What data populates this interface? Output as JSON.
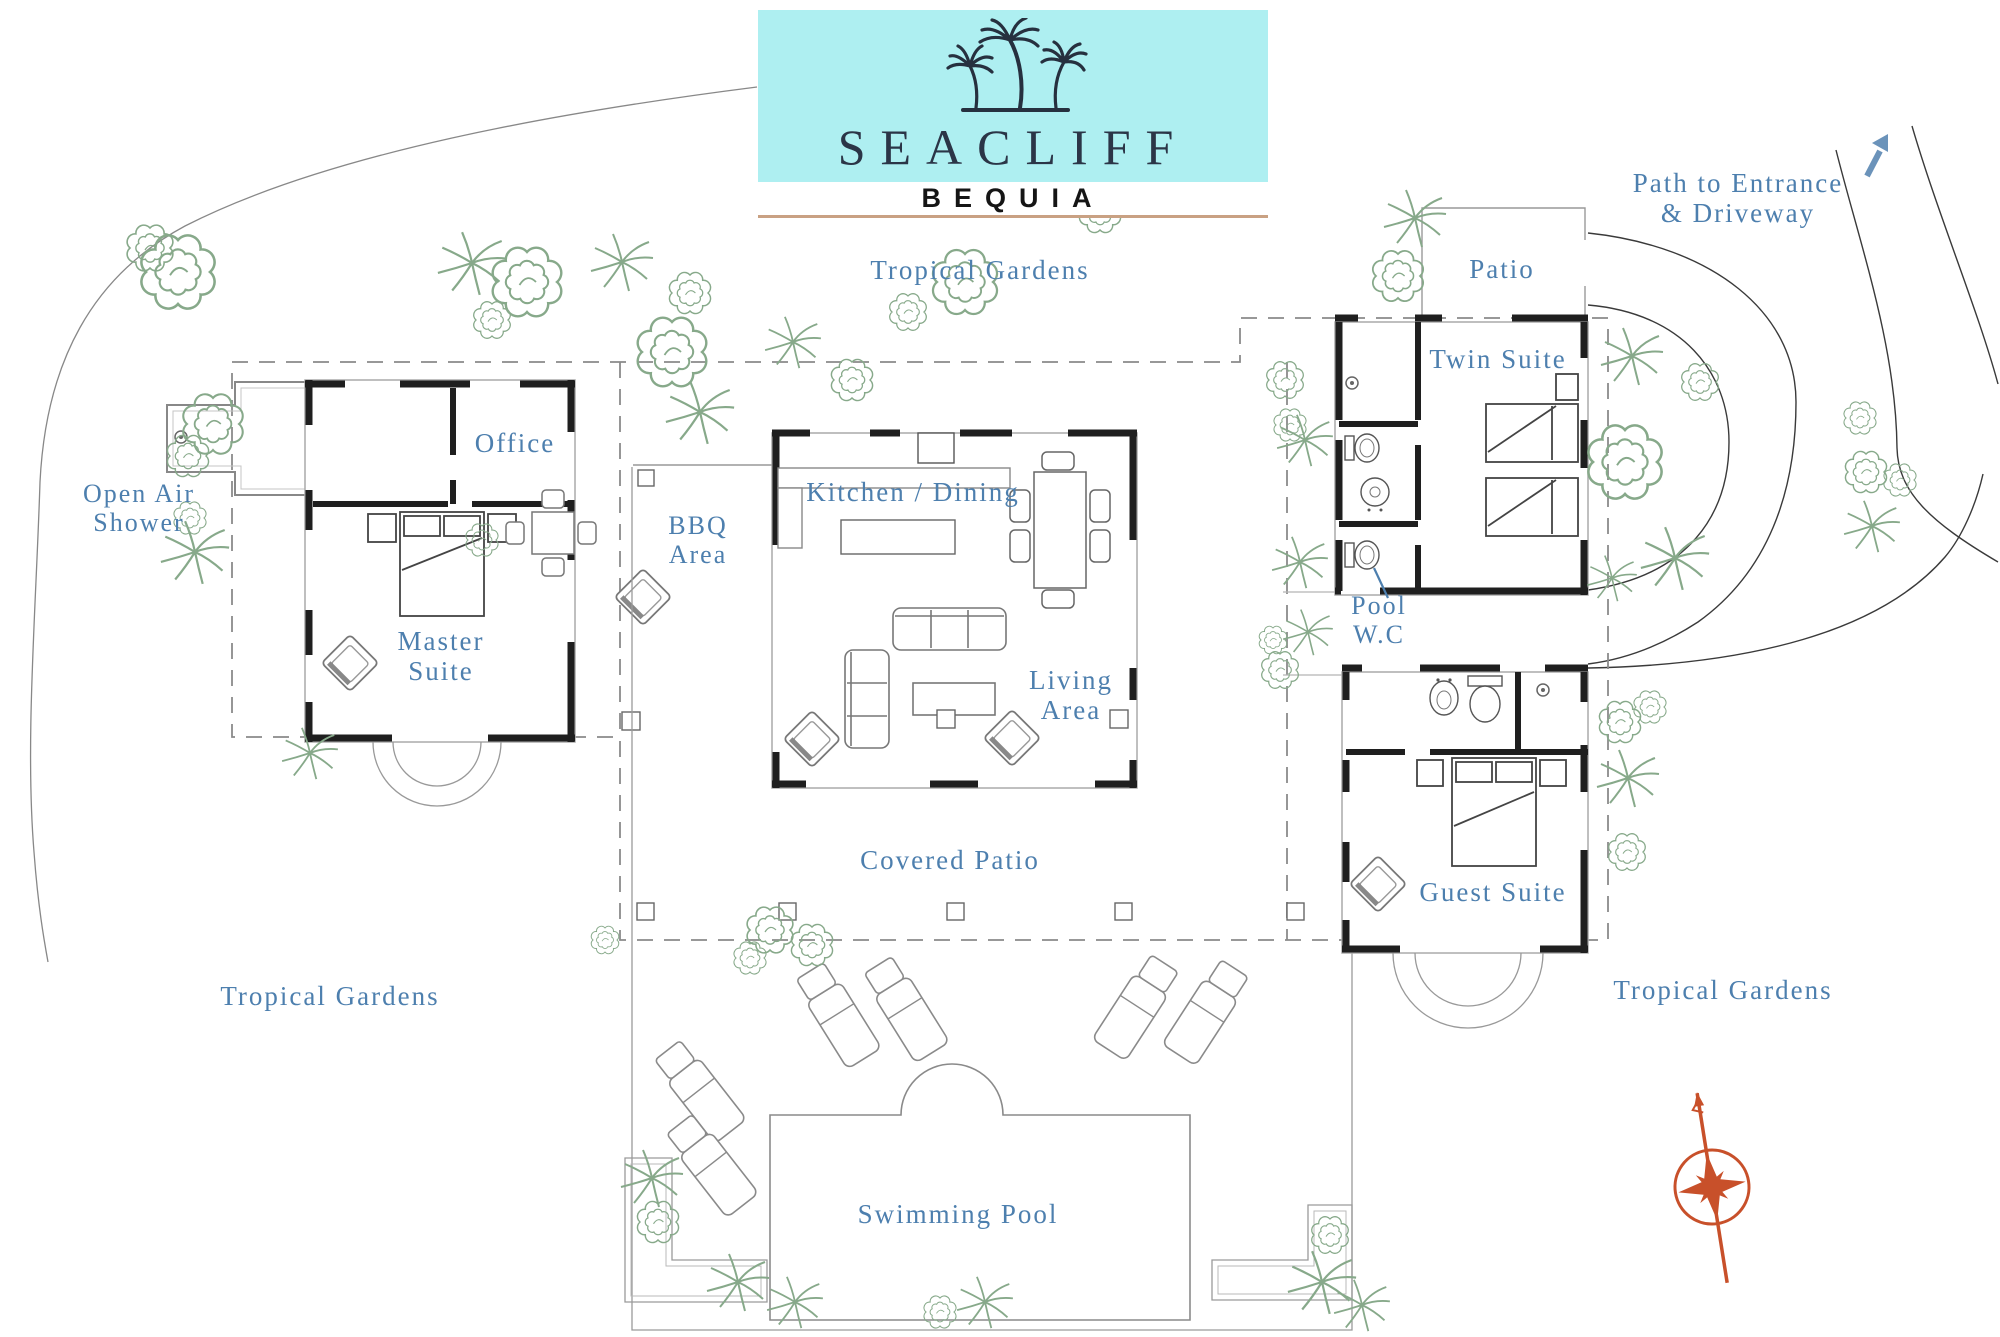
{
  "logo": {
    "name": "SEACLIFF",
    "location": "BEQUIA"
  },
  "labels": {
    "gardens_top": "Tropical Gardens",
    "gardens_left": "Tropical Gardens",
    "gardens_right": "Tropical Gardens",
    "entrance_l1": "Path to Entrance",
    "entrance_l2": "& Driveway",
    "patio": "Patio",
    "twin_suite": "Twin Suite",
    "office": "Office",
    "shower_l1": "Open Air",
    "shower_l2": "Shower",
    "master_l1": "Master",
    "master_l2": "Suite",
    "bbq_l1": "BBQ",
    "bbq_l2": "Area",
    "kitchen_dining": "Kitchen / Dining",
    "living_l1": "Living",
    "living_l2": "Area",
    "pool_wc_l1": "Pool",
    "pool_wc_l2": "W.C",
    "covered_patio": "Covered Patio",
    "guest_suite": "Guest Suite",
    "swimming_pool": "Swimming Pool"
  },
  "colors": {
    "label_blue": "#4d7fae",
    "plant_green": "#87a98a",
    "compass_orange": "#c8502a",
    "logo_teal": "#aeeff1",
    "logo_text": "#2b3547",
    "logo_underline": "#c9a183",
    "arrow_blue": "#6b93ba"
  }
}
